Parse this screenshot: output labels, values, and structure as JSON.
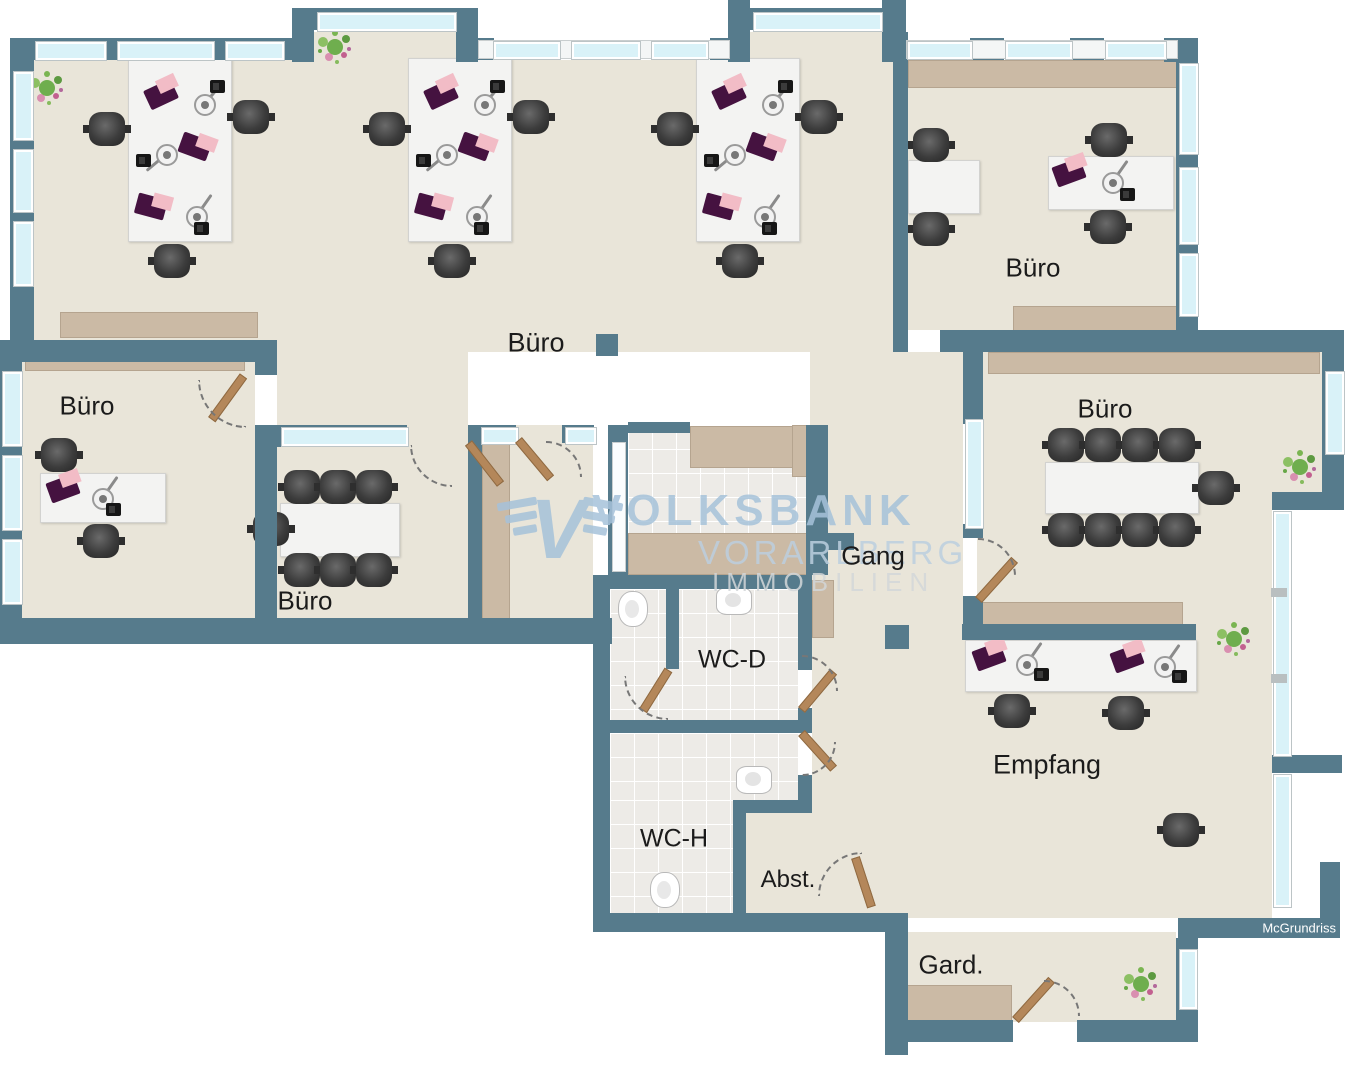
{
  "plan": {
    "credit": "McGrundriss",
    "watermark": {
      "brand": "VOLKSBANK",
      "region": "VORARLBERG",
      "division": "IMMOBILIEN",
      "logo_icon": "volksbank-wings-v-icon"
    },
    "rooms": {
      "open_office": {
        "label": "Büro"
      },
      "office_top_right": {
        "label": "Büro"
      },
      "office_left": {
        "label": "Büro"
      },
      "meeting_small": {
        "label": "Büro"
      },
      "conference": {
        "label": "Büro"
      },
      "corridor": {
        "label": "Gang"
      },
      "wc_women": {
        "label": "WC-D"
      },
      "wc_men": {
        "label": "WC-H"
      },
      "storage": {
        "label": "Abst."
      },
      "reception": {
        "label": "Empfang"
      },
      "wardrobe": {
        "label": "Gard."
      }
    },
    "colors": {
      "wall": "#567b8c",
      "floor": "#e9e5d9",
      "tile": "#edebe7",
      "window": "#d9f2f8",
      "sideboard": "#cbbaa5",
      "desk": "#f3f3f2",
      "chair": "#3c3c3c",
      "laptop": "#451240",
      "door": "#b4875a",
      "reception_counter": "#ececec",
      "watermark_blue": "#a6c2da"
    }
  }
}
